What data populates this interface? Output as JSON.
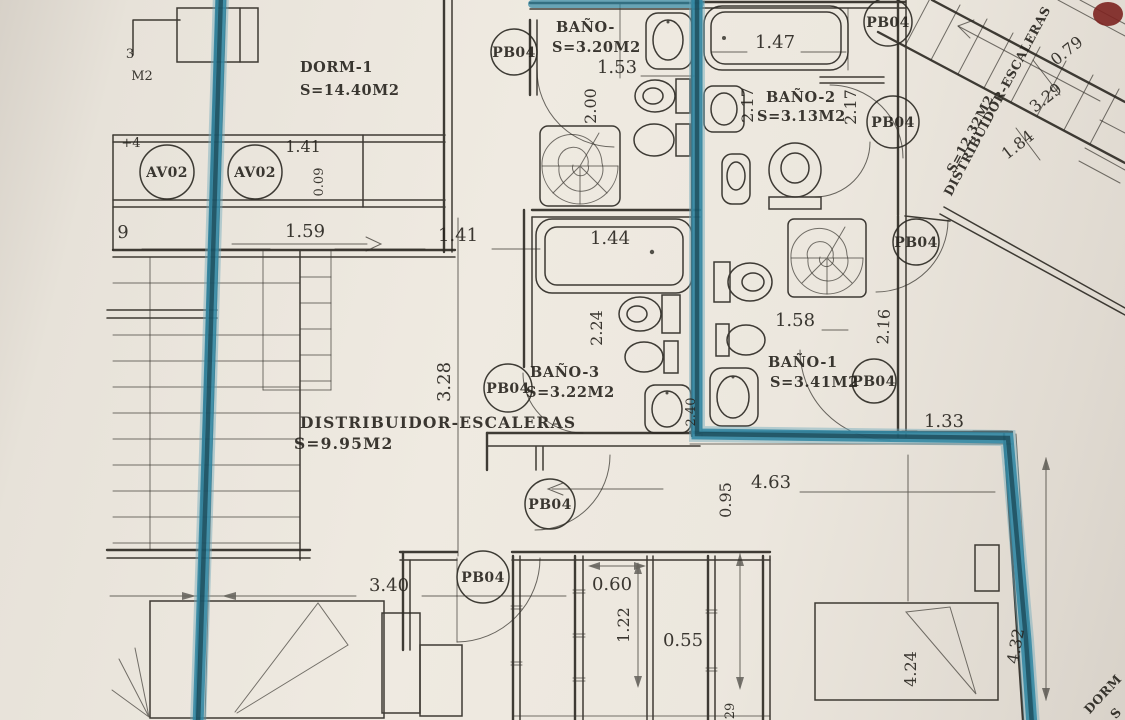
{
  "document": {
    "kind": "Scanned architectural floor plan with highlighted walls",
    "language": "Spanish",
    "highlight_color": "#2f86a2",
    "ink_color": "#2e2b25",
    "paper_color": "#ece7de"
  },
  "rooms": {
    "dorm1": {
      "name": "DORM-1",
      "area": "S=14.40M2"
    },
    "bano_top": {
      "name": "BAÑO-",
      "area": "S=3.20M2"
    },
    "bano2": {
      "name": "BAÑO-2",
      "area": "S=3.13M2"
    },
    "bano3": {
      "name": "BAÑO-3",
      "area": "S=3.22M2"
    },
    "bano1": {
      "name": "BAÑO-1",
      "area": "S=3.41M2"
    },
    "dist_lower": {
      "name": "DISTRIBUIDOR-ESCALERAS",
      "area": "S=9.95M2"
    },
    "dist_upper": {
      "name": "DISTRIBUIDOR-ESCALERAS",
      "area": "S=12.32M2"
    },
    "dorm_corner": {
      "name": "DORM",
      "area": "S"
    }
  },
  "tags": {
    "pb04": "PB04",
    "av02": "AV02"
  },
  "dims": {
    "w147": "1.47",
    "h217a": "2.17",
    "h217b": "2.17",
    "w153": "1.53",
    "h200": "2.00",
    "s079": "0.79",
    "s329": "3.29",
    "s184": "1.84",
    "w141a": "1.41",
    "h009": "0.09",
    "w159": "1.59",
    "w141b": "1.41",
    "w144": "1.44",
    "h224": "2.24",
    "h328": "3.28",
    "w158": "1.58",
    "h216": "2.16",
    "h240": "2.40",
    "w133": "1.33",
    "w463": "4.63",
    "h095": "0.95",
    "w340": "3.40",
    "w060": "0.60",
    "h122": "1.22",
    "w055": "0.55",
    "h424": "4.24",
    "h432": "4.32"
  },
  "fragments": {
    "plus4": "+4",
    "nine": "9",
    "m2": "M2",
    "three": "3",
    "two9": "29"
  }
}
